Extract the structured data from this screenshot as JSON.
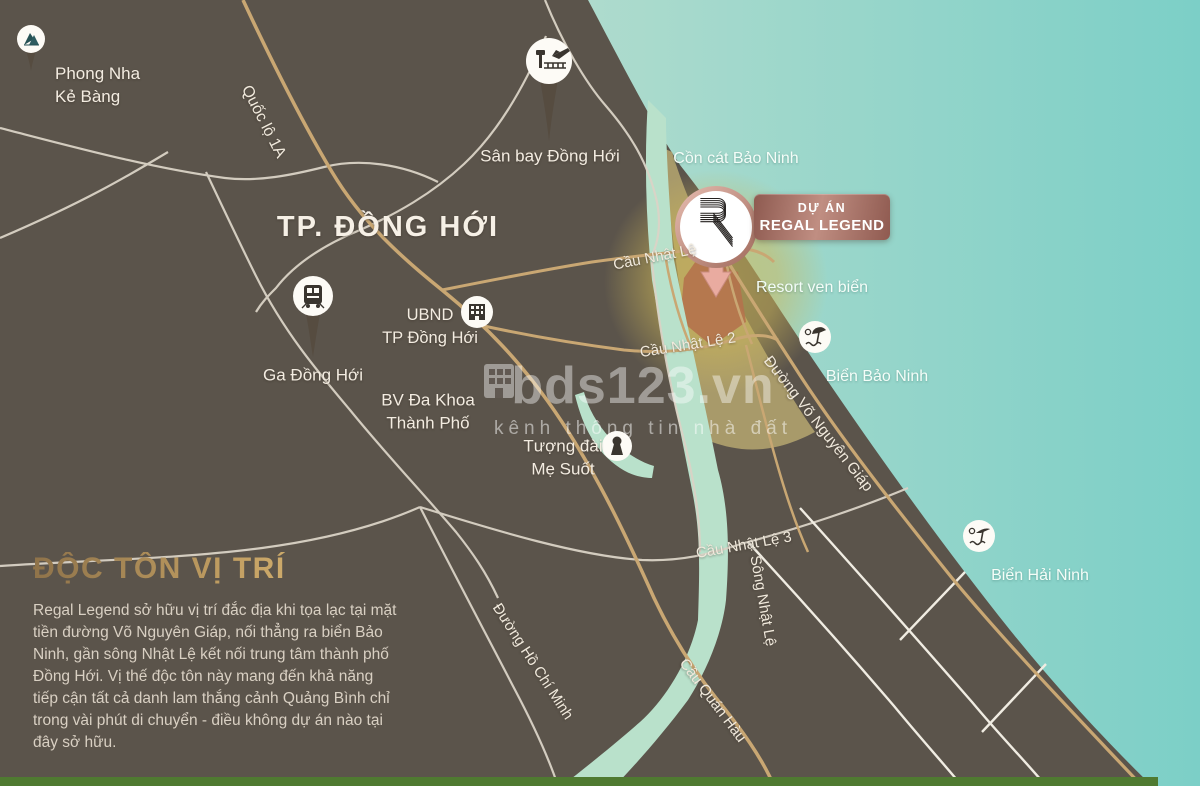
{
  "labels": {
    "phong_nha_1": "Phong Nha",
    "phong_nha_2": "Kẻ Bàng",
    "quoc_lo_1a": "Quốc lộ 1A",
    "san_bay": "Sân bay Đồng Hới",
    "city": "TP. ĐỒNG HỚI",
    "con_cat": "Cồn cát Bảo Ninh",
    "cau_nhat_le": "Cầu Nhật Lệ",
    "resort": "Resort ven biển",
    "ubnd_1": "UBND",
    "ubnd_2": "TP Đồng Hới",
    "cau_nhat_le_2": "Cầu Nhật Lệ 2",
    "vo_nguyen_giap": "Đường Võ Nguyên Giáp",
    "bien_bao_ninh": "Biển Bảo Ninh",
    "ga_dong_hoi": "Ga Đồng Hới",
    "bv_1": "BV Đa Khoa",
    "bv_2": "Thành Phố",
    "tuong_dai_1": "Tượng đài",
    "tuong_dai_2": "Mẹ Suốt",
    "cau_nhat_le_3": "Cầu Nhật Lệ 3",
    "bien_hai_ninh": "Biển Hải Ninh",
    "song_nhat_le": "Sông Nhật Lệ",
    "ho_chi_minh": "Đường Hồ Chí Minh",
    "cau_quan_hau": "Cầu Quán Hàu"
  },
  "project": {
    "tag": "DỰ ÁN",
    "name": "REGAL LEGEND"
  },
  "watermark": {
    "brand": "bds123.vn",
    "tagline": "kênh thông tin nhà đất"
  },
  "info": {
    "heading": "ĐỘC TÔN VỊ TRÍ",
    "body": "Regal Legend sở hữu vị trí đắc địa khi tọa lạc tại mặt tiền đường Võ Nguyên Giáp, nối thẳng ra biển Bảo Ninh, gần sông Nhật Lệ kết nối trung tâm thành phố Đồng Hới. Vị thế độc tôn này mang đến khả năng tiếp cận tất cả danh lam thắng cảnh Quảng Bình chỉ trong vài phút di chuyển - điều không dự án nào tại đây sở hữu."
  },
  "icons": {
    "mountain-icon": "▲ national park peaks",
    "airport-icon": "✈ control tower + runway",
    "train-icon": "locomotive front",
    "government-building-icon": "building with window grid",
    "statue-icon": "person silhouette keyhole",
    "beach-umbrella-icon": "umbrella + sun + waves",
    "regal-logo-icon": "ribbon letter R",
    "map-pin-arrow-icon": "downward arrow marker",
    "watermark-building-icon": "small building"
  },
  "colors": {
    "land": "#5b544b",
    "sea_left": "#aedbcd",
    "sea_right": "#7ccfc7",
    "river": "#b9e1cb",
    "dune_sand": "#a89a6a",
    "halo_gold": "#cdb758",
    "road_gold": "#c9a773",
    "road_white": "#dad3c6",
    "project_parcel": "#b4724c",
    "plate_rose": "#c08e82",
    "heading_gold": "#e6c47f",
    "bottom_strip_green": "#4f7a31"
  }
}
